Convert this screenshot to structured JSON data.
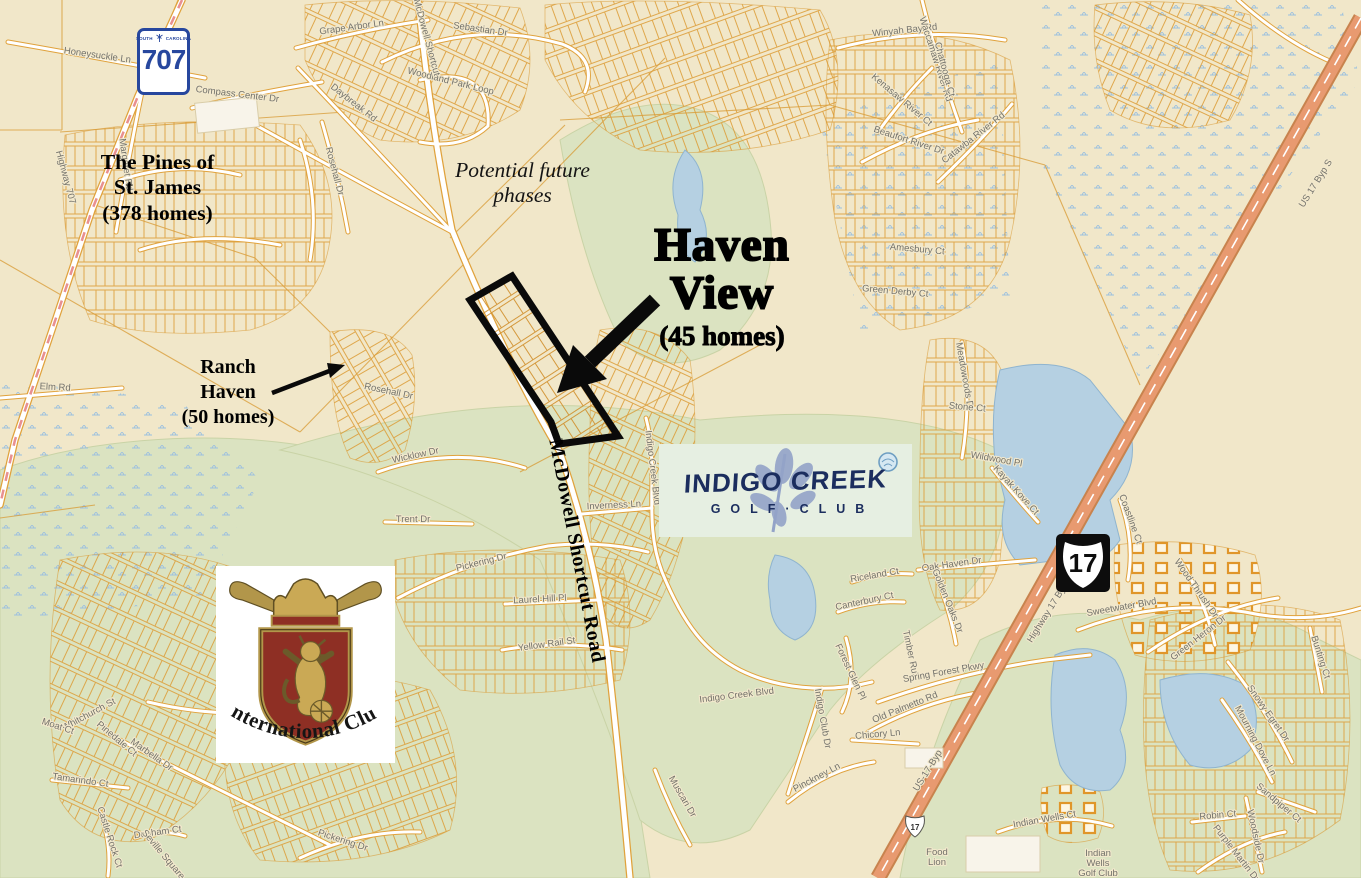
{
  "colors": {
    "map_background": "#f1e7c9",
    "golf_green": "#dbe3c1",
    "water_blue": "#b5d0e2",
    "parcel_orange": "#dc9c36",
    "highway_salmon": "#e89a70",
    "annotation_black": "#000000",
    "indigo_navy": "#1b2d5e",
    "logo_leaf_periwinkle": "#93a3c8",
    "crest_red": "#8e2f24",
    "crest_gold": "#b2964a",
    "shield_blue": "#27479e"
  },
  "annotations": {
    "pines": "The Pines of\nSt. James\n(378 homes)",
    "future_phases": "Potential future\nphases",
    "haven_title": "Haven\nView",
    "haven_homes": "(45 homes)",
    "ranch": "Ranch\nHaven\n(50 homes)",
    "mcdowell_road": "McDowell Shortcut Road"
  },
  "shields": {
    "sc707": {
      "state_left": "SOUTH",
      "state_right": "CAROLINA",
      "number": "707"
    },
    "us17": {
      "number": "17"
    },
    "us17_small": "17"
  },
  "logos": {
    "indigo_creek": {
      "line1": "INDIGO CREEK",
      "line2": "GOLF·CLUB"
    },
    "international_club": {
      "name": "International Club"
    }
  },
  "map": {
    "street_labels": [
      {
        "t": "Honeysuckle Ln",
        "x": 97,
        "y": 58,
        "r": 8
      },
      {
        "t": "Margaret Rd",
        "x": 123,
        "y": 165,
        "r": 82
      },
      {
        "t": "Highway 707",
        "x": 63,
        "y": 178,
        "r": 75
      },
      {
        "t": "Grape Arbor Ln",
        "x": 352,
        "y": 30,
        "r": -8
      },
      {
        "t": "Compass Center Dr",
        "x": 237,
        "y": 97,
        "r": 7
      },
      {
        "t": "Daybreak Rd",
        "x": 352,
        "y": 105,
        "r": 38
      },
      {
        "t": "Sebastian Dr",
        "x": 480,
        "y": 32,
        "r": 8
      },
      {
        "t": "Woodland Park Loop",
        "x": 450,
        "y": 84,
        "r": 14
      },
      {
        "t": "McDowell Shortcut",
        "x": 424,
        "y": 38,
        "r": 75
      },
      {
        "t": "Rosehall Dr",
        "x": 332,
        "y": 172,
        "r": 75
      },
      {
        "t": "Rosehall Dr",
        "x": 388,
        "y": 394,
        "r": 12
      },
      {
        "t": "Elm Rd",
        "x": 55,
        "y": 390,
        "r": 3
      },
      {
        "t": "Winyah Bay Rd",
        "x": 905,
        "y": 33,
        "r": -6
      },
      {
        "t": "Waccamaw River Rd",
        "x": 933,
        "y": 60,
        "r": 72
      },
      {
        "t": "Chattooga Ct",
        "x": 942,
        "y": 70,
        "r": 75
      },
      {
        "t": "Kenasaw River Ct",
        "x": 900,
        "y": 102,
        "r": 40
      },
      {
        "t": "Beaufort River Dr",
        "x": 908,
        "y": 143,
        "r": 18
      },
      {
        "t": "Catawba River Rd",
        "x": 975,
        "y": 140,
        "r": -38
      },
      {
        "t": "Amesbury Ct",
        "x": 917,
        "y": 252,
        "r": 5
      },
      {
        "t": "Green Derby Ct",
        "x": 895,
        "y": 294,
        "r": 5
      },
      {
        "t": "Wicklow Dr",
        "x": 416,
        "y": 458,
        "r": -12
      },
      {
        "t": "Trent Dr",
        "x": 413,
        "y": 522,
        "r": 0
      },
      {
        "t": "Pickering Dr",
        "x": 482,
        "y": 565,
        "r": -14
      },
      {
        "t": "Laurel Hill Pl",
        "x": 540,
        "y": 602,
        "r": -3
      },
      {
        "t": "Yellow Rail St",
        "x": 547,
        "y": 647,
        "r": -8
      },
      {
        "t": "Inverness Ln",
        "x": 614,
        "y": 508,
        "r": -3
      },
      {
        "t": "Indigo Creek Blvd",
        "x": 650,
        "y": 468,
        "r": 83
      },
      {
        "t": "Indigo Creek Blvd",
        "x": 737,
        "y": 698,
        "r": -7
      },
      {
        "t": "Indigo Club Dr",
        "x": 820,
        "y": 719,
        "r": 80
      },
      {
        "t": "Riceland Ct",
        "x": 875,
        "y": 578,
        "r": -10
      },
      {
        "t": "Canterbury Ct",
        "x": 865,
        "y": 604,
        "r": -12
      },
      {
        "t": "Oak Haven Dr",
        "x": 952,
        "y": 567,
        "r": -8
      },
      {
        "t": "Golden Oaks Dr",
        "x": 945,
        "y": 602,
        "r": 68
      },
      {
        "t": "Timber Run",
        "x": 908,
        "y": 655,
        "r": 78
      },
      {
        "t": "Spring Forest Pkwy",
        "x": 944,
        "y": 675,
        "r": -10
      },
      {
        "t": "Old Palmetto Rd",
        "x": 906,
        "y": 710,
        "r": -22
      },
      {
        "t": "Forest Glen Pl",
        "x": 848,
        "y": 673,
        "r": 65
      },
      {
        "t": "Chicory Ln",
        "x": 878,
        "y": 737,
        "r": -5
      },
      {
        "t": "Pinckney Ln",
        "x": 818,
        "y": 780,
        "r": -28
      },
      {
        "t": "Muscari Dr",
        "x": 680,
        "y": 798,
        "r": 60
      },
      {
        "t": "Sweetwater Blvd",
        "x": 1122,
        "y": 610,
        "r": -10
      },
      {
        "t": "Highway 17 Byp",
        "x": 1050,
        "y": 614,
        "r": -58,
        "c": "#ffffff"
      },
      {
        "t": "US-17-Byp",
        "x": 930,
        "y": 772,
        "r": -58,
        "c": "#ffffff"
      },
      {
        "t": "US 17 Byp S",
        "x": 1318,
        "y": 185,
        "r": -58,
        "c": "#8a4a2a"
      },
      {
        "t": "Wood Thrush Dr",
        "x": 1194,
        "y": 590,
        "r": 55
      },
      {
        "t": "Coastline Ct",
        "x": 1128,
        "y": 520,
        "r": 70
      },
      {
        "t": "Meadowoods Dr",
        "x": 962,
        "y": 377,
        "r": 80
      },
      {
        "t": "Stone Ct",
        "x": 967,
        "y": 410,
        "r": 5
      },
      {
        "t": "Wildwood Pl",
        "x": 996,
        "y": 462,
        "r": 10
      },
      {
        "t": "Kayak Kove Ct",
        "x": 1014,
        "y": 492,
        "r": 48
      },
      {
        "t": "Green Heron Dr",
        "x": 1200,
        "y": 640,
        "r": -38
      },
      {
        "t": "Bunting Ct",
        "x": 1318,
        "y": 658,
        "r": 72
      },
      {
        "t": "Snowy Egret Dr",
        "x": 1266,
        "y": 715,
        "r": 55
      },
      {
        "t": "Mourning Dove Ln",
        "x": 1253,
        "y": 742,
        "r": 62
      },
      {
        "t": "Sandpiper Ct",
        "x": 1277,
        "y": 805,
        "r": 40
      },
      {
        "t": "Robin Ct",
        "x": 1218,
        "y": 818,
        "r": -5
      },
      {
        "t": "Woodside Dr",
        "x": 1253,
        "y": 837,
        "r": 78
      },
      {
        "t": "Purple Martin Dr",
        "x": 1234,
        "y": 855,
        "r": 52
      },
      {
        "t": "Indian Wells Ct",
        "x": 1045,
        "y": 822,
        "r": -10
      },
      {
        "t": "Whitchurch St",
        "x": 90,
        "y": 717,
        "r": -28
      },
      {
        "t": "Moat Ct",
        "x": 57,
        "y": 729,
        "r": 18
      },
      {
        "t": "Pinedale Ct",
        "x": 115,
        "y": 741,
        "r": 40
      },
      {
        "t": "Marbella Dr",
        "x": 150,
        "y": 757,
        "r": 35
      },
      {
        "t": "Tamarindo Ct",
        "x": 80,
        "y": 783,
        "r": 8
      },
      {
        "t": "Castle Rock Ct",
        "x": 107,
        "y": 838,
        "r": 72
      },
      {
        "t": "Dunham Ct",
        "x": 158,
        "y": 835,
        "r": -8
      },
      {
        "t": "Seville Square Ct",
        "x": 165,
        "y": 861,
        "r": 50
      },
      {
        "t": "Pickering Dr",
        "x": 342,
        "y": 843,
        "r": 18
      },
      {
        "t": "Food Lion",
        "x": 937,
        "y": 855,
        "r": 0,
        "s": 8,
        "c": "#8a8a7c",
        "lines": "Food\nLion"
      },
      {
        "t": "Indian Wells Golf Club",
        "x": 1098,
        "y": 856,
        "r": 0,
        "s": 9,
        "c": "#7f9e5a",
        "lines": "Indian\nWells\nGolf Club"
      }
    ]
  }
}
